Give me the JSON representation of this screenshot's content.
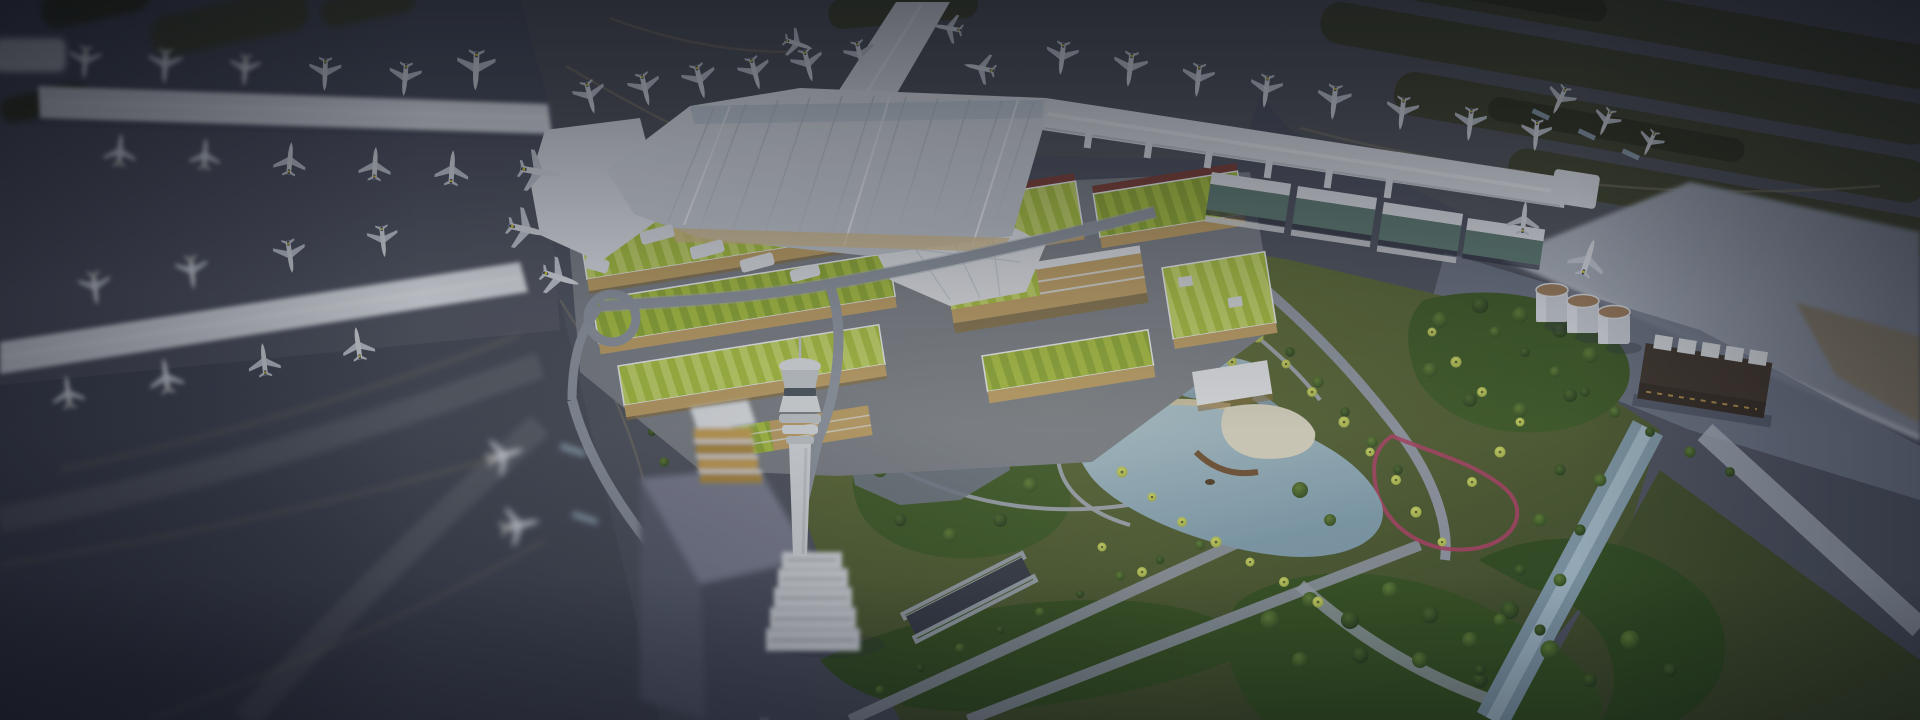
{
  "canvas": {
    "width": 1920,
    "height": 720
  },
  "scene": {
    "subject": "airport-masterplan-aerial-render",
    "features": [
      "terminal-piers-with-parked-airplanes",
      "green-roof-complex",
      "landscape-park-with-lake",
      "control-tower",
      "runway-aprons",
      "fuel-tanks",
      "utility-building"
    ]
  },
  "palette": {
    "base": "#4d5260",
    "baseDark": "#464b59",
    "apron": "#55585f",
    "apronMid": "#525663",
    "taxiBand": "#5a5e69",
    "taxiLine": "#867f6a",
    "grass": "#444830",
    "grassDark": "#343823",
    "white": "#e4e8ee",
    "whiteShade": "#c6ccd6",
    "ridge": "#f3f6fa",
    "skylight": "#bccddc",
    "glow": "#d9bf8c",
    "glassTeal": "#5f7d75",
    "roofA": "#abc43f",
    "roofB": "#c6da67",
    "roofDark": "#90ad33",
    "redBand": "#7c3e35",
    "tan": "#c2a265",
    "tanShadow": "#8a7040",
    "podium": "#7b8089",
    "lawnA": "#65763a",
    "lawnB": "#3f4c29",
    "forest1": "#34501f",
    "forest2": "#2f4a1e",
    "forest3": "#3b5824",
    "treeLight": "#5f8034",
    "treeDark": "#2c451d",
    "treeLight2": "#4a682c",
    "treeDark2": "#22371a",
    "palmLight": "#dbe36e",
    "palmDark": "#93a43c",
    "palmCore": "#5c662a",
    "pathC": "#9aa3ac",
    "road": "#8e96a3",
    "roadLight": "#a7b0bc",
    "slot": "#343946",
    "waterA": "#aec6d2",
    "waterB": "#7e9dae",
    "waterDeep": "#7f98a8",
    "sand": "#cfc3a4",
    "deck": "#dcd7c5",
    "bridge": "#6e4e30",
    "boat": "#513b26",
    "track": "#a83f63",
    "planeBody": "#dfe3e9",
    "planeWing": "#c9cfd8",
    "tailNavy": "#2e3a55",
    "tailYellow": "#d8c533",
    "towerLight": "#dde1e7",
    "towerMid": "#c4cad2",
    "towerBand": "#46505e",
    "tankBody": "#c9ced6",
    "tankTop": "#9b7a5a",
    "darkBld": "#3e332b",
    "darkBldFace": "#332a23",
    "unitWhite": "#d9dde2",
    "wedgeA": "#b9c0cb",
    "wedgeB": "#7f8694",
    "fieldTan": "#857c69",
    "stripGround": "#707888",
    "prismTop": "#7b8095",
    "prismFaceA": "#5a5f72",
    "prismFaceB": "#4d5164",
    "glaze": "#c9a253",
    "glazeDark": "#b08c41",
    "bridgeBlue": "#9fb6c9",
    "shadow": "#2c3140",
    "vignette": "#060810",
    "warmGlow": "#ffeeb0"
  }
}
